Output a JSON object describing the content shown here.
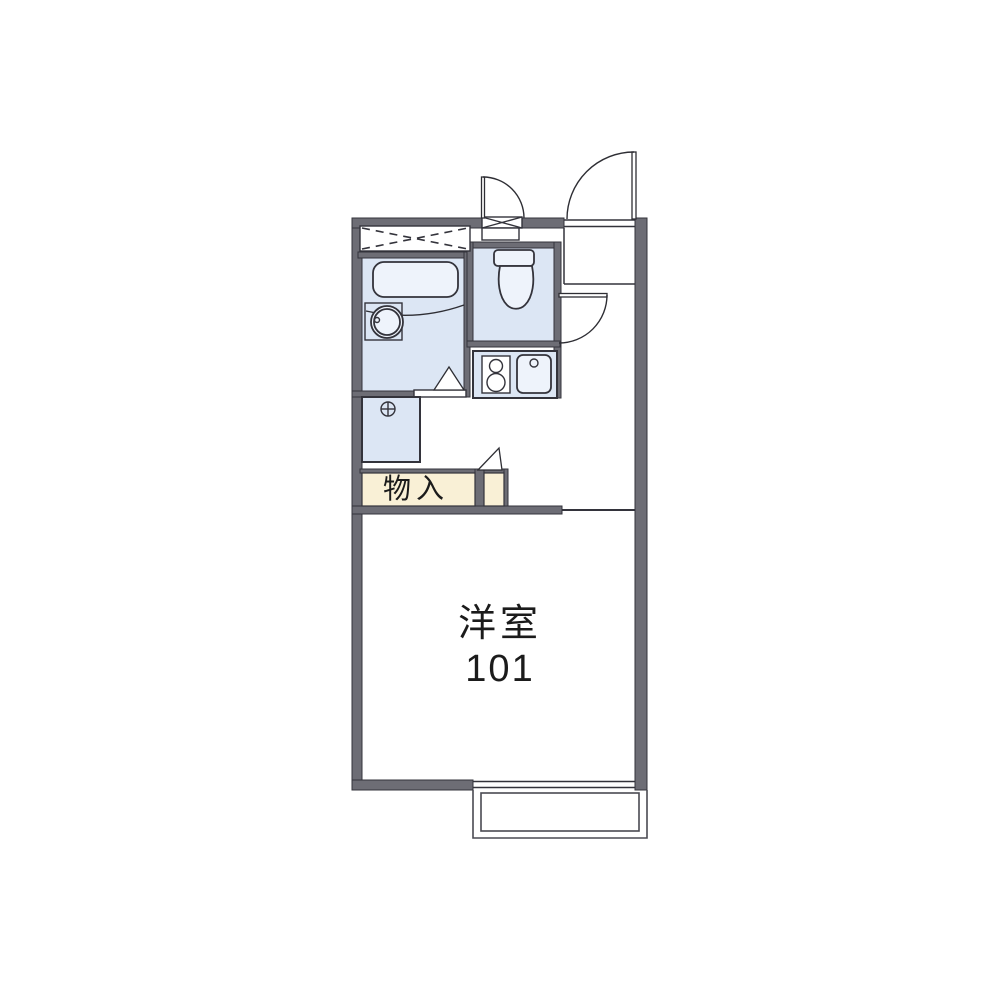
{
  "floorplan": {
    "room_label": {
      "line1": "洋室",
      "line2": "101"
    },
    "closet_label": "物入",
    "colors": {
      "wall": "#6d6d75",
      "line": "#33333b",
      "roomblue": "#dce6f4",
      "fixwhite": "#eef3fb",
      "cream": "#f9f0d6",
      "text": "#1b1b1b",
      "bg": "#ffffff"
    },
    "fixtures": [
      "bathtub",
      "wash-basin",
      "vanity-counter",
      "overhead-storage",
      "toilet",
      "washing-machine-pan",
      "floor-drain",
      "kitchen-stove",
      "kitchen-sink",
      "entry-door",
      "toilet-door",
      "hall-door",
      "bathroom-folding-door",
      "closet",
      "closet-side-door",
      "sliding-window",
      "balcony"
    ]
  }
}
